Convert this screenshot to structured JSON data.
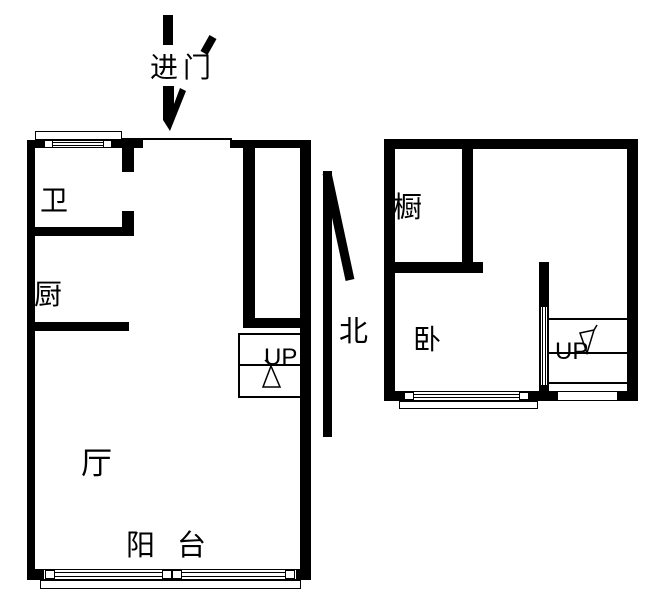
{
  "annotations": {
    "entry_label": "进门",
    "north_label": "北"
  },
  "left_unit": {
    "bathroom_label": "卫",
    "kitchen_label": "厨",
    "living_room_label": "厅",
    "balcony_label": "阳台",
    "stairs_up_label": "UP"
  },
  "right_unit": {
    "cabinet_label": "橱",
    "bedroom_label": "卧",
    "stairs_up_label": "UP"
  },
  "colors": {
    "wall": "#000000",
    "background": "#ffffff",
    "text": "#000000"
  }
}
